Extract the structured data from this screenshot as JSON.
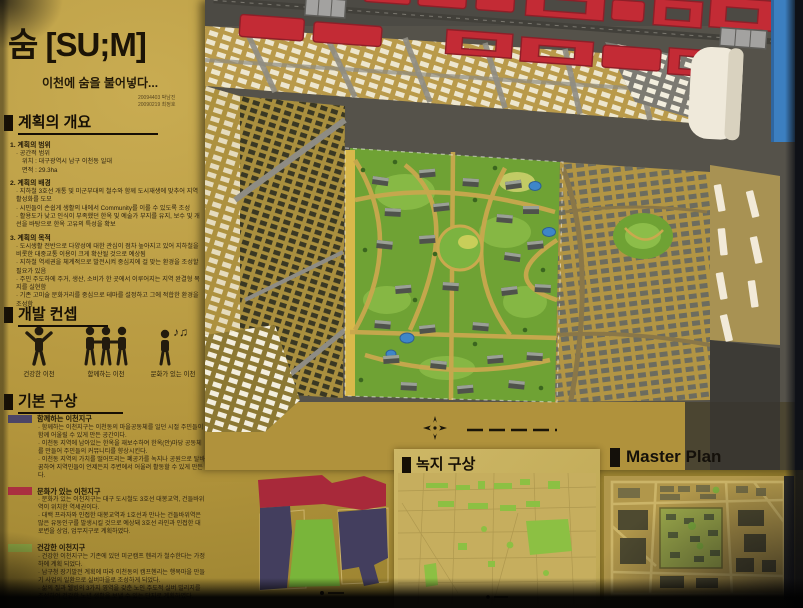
{
  "board": {
    "title": "숨 [SU;M]",
    "subtitle": "이천에 숨을 불어넣다...",
    "credit_line1": "20094403 박남진",
    "credit_line2": "20090219 최정호"
  },
  "sections": {
    "overview": {
      "heading": "계획의 개요",
      "item1_title": "1. 계획의 범위",
      "item1_lines": [
        "· 공간적 범위",
        "위치 : 대구광역시 남구 이천동 일대",
        "면적 : 29.3ha"
      ],
      "item2_title": "2. 계획의 배경",
      "item2_lines": [
        "· 지하철 3호선 개통 및 미군부대의 철수와 함께 도시재생에 맞추어 지역 활성화를 도모",
        "· 시민들이 손쉽게 생활의 내에서 Community를 이룰 수 있도록 조성",
        "· 활용도가 낮고 인식이 부족했던 한옥 및 예술가 부지를 유지, 보수 및 개선을 바탕으로 한옥 고유의 특성을 확보"
      ],
      "item3_title": "3. 계획의 목적",
      "item3_lines": [
        "· 도시생활 전반으로 다양성에 대한 관심이 점차 높아지고 있어 지하철을 비롯한 대중교통 이용이 크게 확산될 것으로 예상됨",
        "· 지하철 역세권을 체계적으로 발전시켜 중심지에 걸 맞는 환경을 조성할 필요가 있음",
        "· 주민 주도하에 주거, 생산, 소비가 한 곳에서 이루어지는 지역 완결형 복지를 실현함",
        "· 기존 고미술 문화거리를 중심으로 테마를 설정하고 그에 적합한 환경을 조성함"
      ]
    },
    "concept": {
      "heading": "개발 컨셉",
      "items": [
        {
          "label": "건강한 이천",
          "icon": "person-arms-raised-icon"
        },
        {
          "label": "함께하는 이천",
          "icon": "people-holding-hands-icon"
        },
        {
          "label": "문화가 있는 이천",
          "icon": "person-music-icon",
          "note_glyphs": "♪♫"
        }
      ]
    },
    "basic": {
      "heading": "기본 구상",
      "zones": [
        {
          "name": "함께하는 이천지구",
          "color": "#4c4566",
          "bullets": [
            "· 함께하는 이천지구는 이천동의 마을공동체를 일던 시절 주민들이 함께 어울릴 수 있게 만든 공간이다.",
            "· 이천동 지역에 남아있는 한옥을 재보수하여 한옥(안)마당 공동체를 만들어 주민들의 커뮤니티를 향상시킨다.",
            "· 이천동 지역의 가치를 떨어뜨리는 폐공가를 녹지나 공원으로 탈바꿈하여 지역민들이 언제든지 주변에서 어울려 활동할 수 있게 만든다."
          ]
        },
        {
          "name": "문화가 있는 이천지구",
          "color": "#aa2f40",
          "bullets": [
            "· 문화가 있는 이천지구는 대구 도시철도 3호선 대봉교역, 건들바위역이 위치한 역세권이다.",
            "· 대백 프라자와 인접한 대봉교역과 1호선과 만나는 건들바위역은 많은 유동인구를 발생시킬 것으로 예상돼 3호선 라인과 인접한 대로변을 상업, 업무지구로 계획하였다."
          ]
        },
        {
          "name": "건강한 이천지구",
          "color": "#8ca644",
          "bullets": [
            "· 건강한 이천지구는 기존에 있던 미군캠프 헨리가 철수한다는 가정하에 계획 되었다.",
            "· 남구청 장기발전 계획에 따라 이천동의 캠프헨리는 행복마을 만들기 사업의 일환으로 실버마을로 조성하게 되었다.",
            "· 삶의 질과 웰빙의 3가지 영역을 갖춘 노인 주도적 실버 빌리지를 조성하여 건강한 노년 생활을 보낼 수 있는 단지로 계획하였다."
          ]
        }
      ]
    },
    "green": {
      "heading": "녹지 구상"
    },
    "master": {
      "heading": "Master Plan"
    }
  },
  "colors": {
    "board": "#b3953c",
    "model_red": "#c32b35",
    "park_green": "#6fa234",
    "pond_blue": "#3e86c8",
    "zone_purple": "#4c4566",
    "zone_red": "#aa2f40",
    "zone_green": "#8ca644",
    "tape_blue": "#3c7fc0"
  }
}
